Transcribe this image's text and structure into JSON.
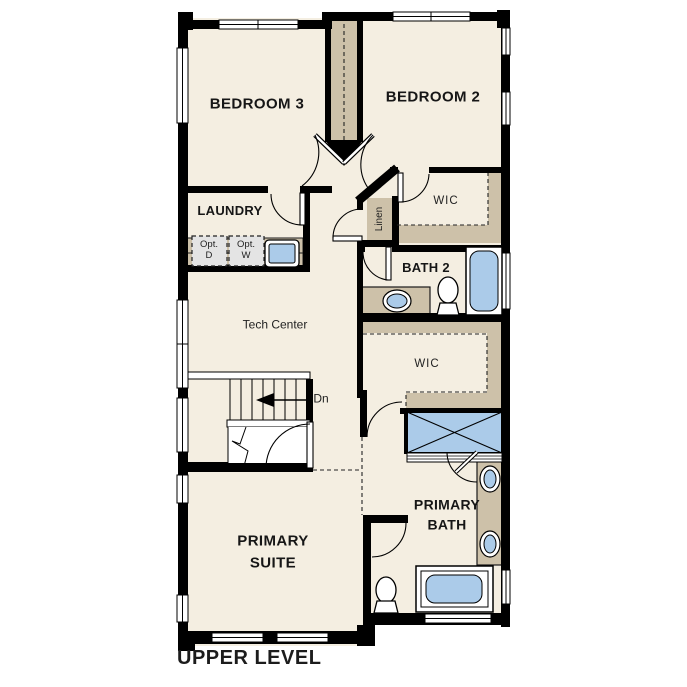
{
  "title": "UPPER LEVEL",
  "rooms": {
    "bedroom3": {
      "label": "BEDROOM 3"
    },
    "bedroom2": {
      "label": "BEDROOM 2"
    },
    "laundry": {
      "label": "LAUNDRY"
    },
    "wic_upper": {
      "label": "WIC"
    },
    "linen": {
      "label": "Linen"
    },
    "bath2": {
      "label": "BATH 2"
    },
    "tech_center": {
      "label": "Tech Center"
    },
    "wic_lower": {
      "label": "WIC"
    },
    "primary_bath": {
      "label": "PRIMARY\nBATH"
    },
    "primary_suite": {
      "label": "PRIMARY\nSUITE"
    }
  },
  "annotations": {
    "stairs_direction": "Dn",
    "opt_dryer": "Opt.\nD",
    "opt_washer": "Opt.\nW"
  },
  "colors": {
    "floor": "#f4eee1",
    "wall": "#000000",
    "cabinetry_tan": "#cdc1a9",
    "fixture_blue": "#abcbe9",
    "opt_box_gray": "#e4e4e4",
    "text": "#1c1c1c"
  }
}
